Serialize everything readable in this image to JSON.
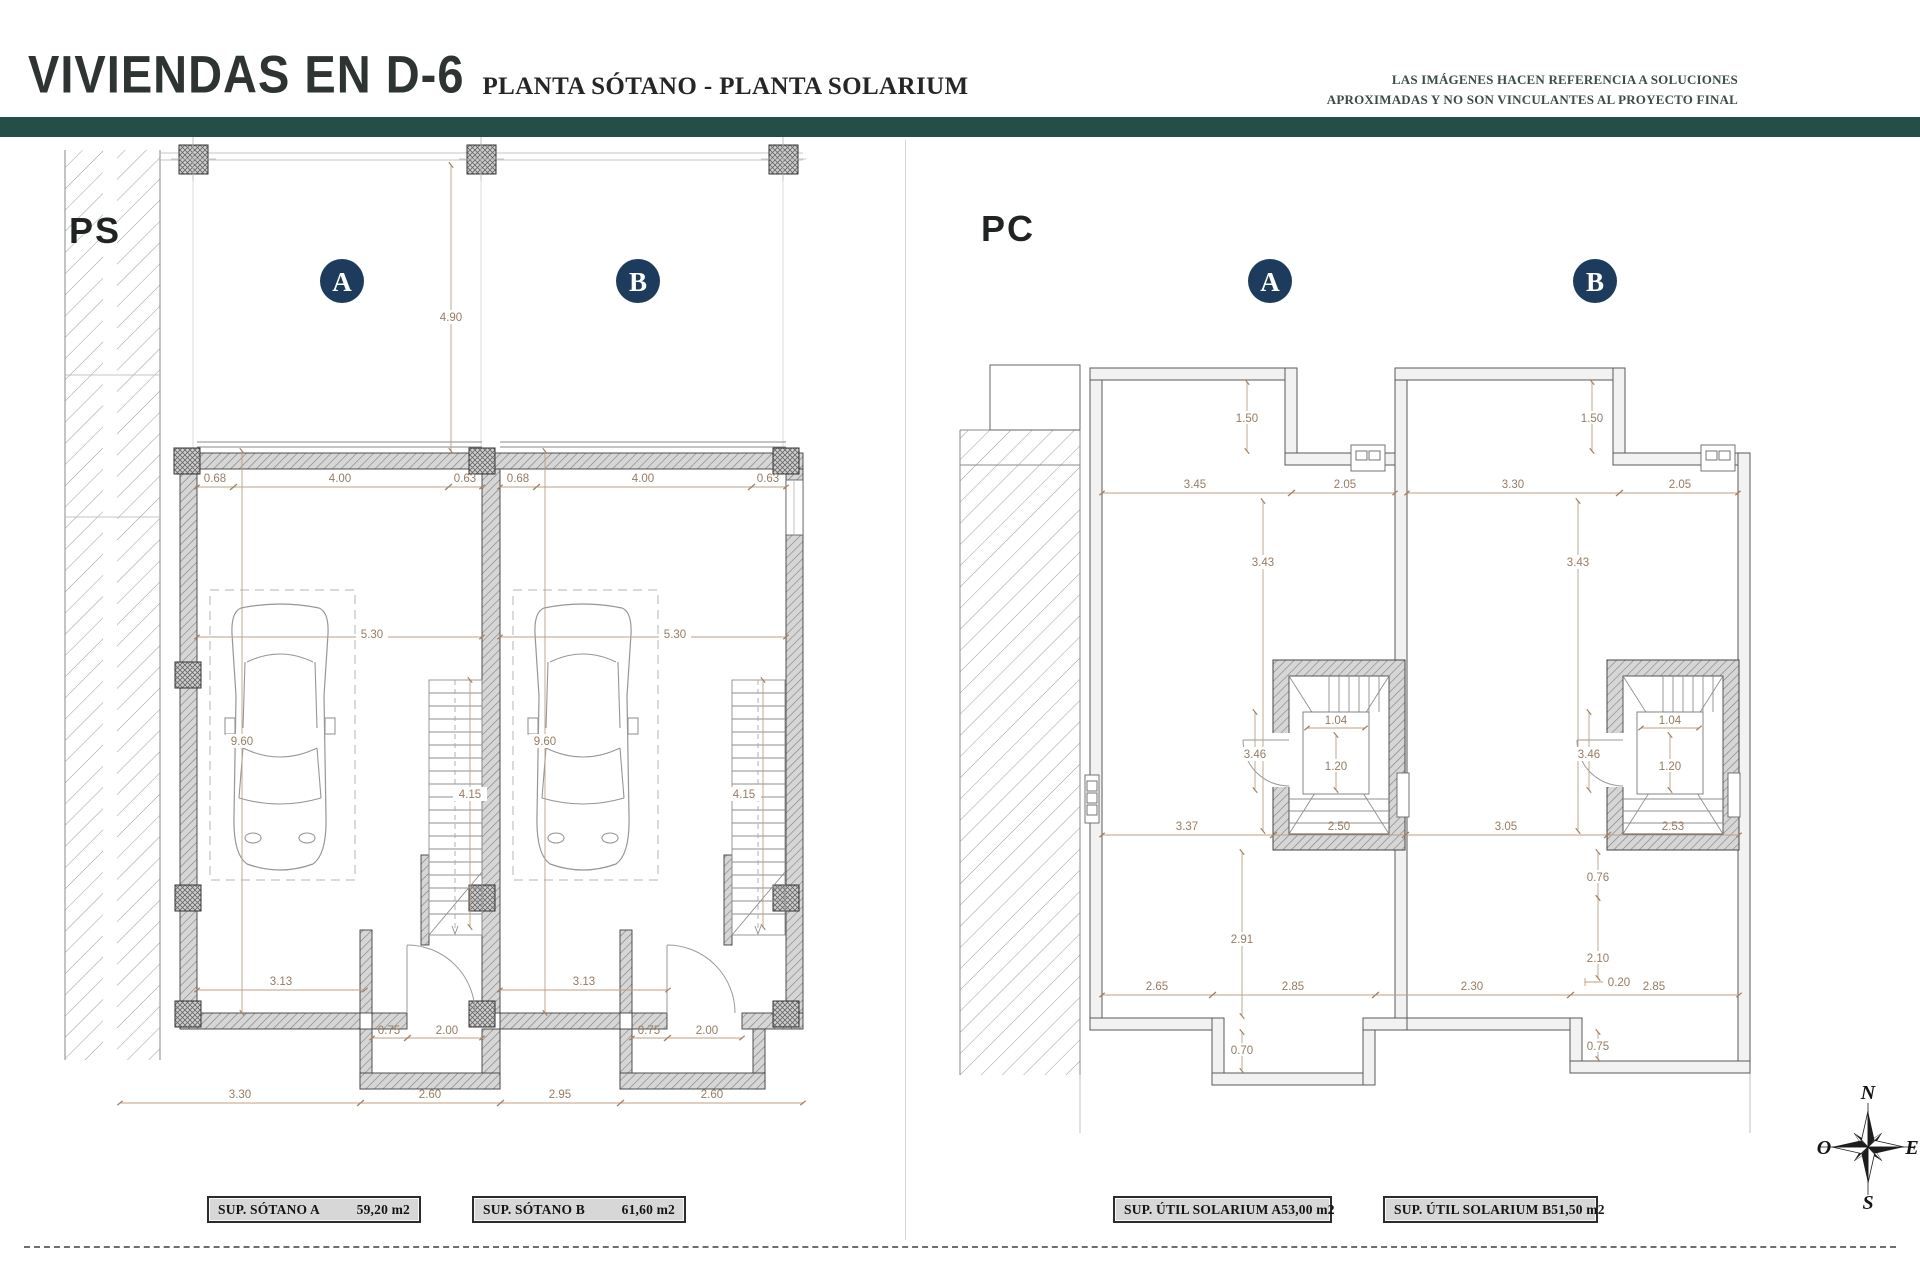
{
  "header": {
    "title": "VIVIENDAS EN D-6",
    "subtitle": "PLANTA SÓTANO - PLANTA SOLARIUM",
    "disclaimer1": "LAS IMÁGENES HACEN REFERENCIA A SOLUCIONES",
    "disclaimer2": "APROXIMADAS Y NO SON VINCULANTES AL PROYECTO FINAL"
  },
  "plans": {
    "ps": {
      "code": "PS",
      "unit_a": "A",
      "unit_b": "B",
      "dims": {
        "top_span": "4.90",
        "a_left": "0.68",
        "a_main": "4.00",
        "a_right": "0.63",
        "b_left": "0.68",
        "b_main": "4.00",
        "b_right": "0.63",
        "a_width": "5.30",
        "b_width": "5.30",
        "a_depth": "9.60",
        "b_depth": "9.60",
        "a_stair": "4.15",
        "b_stair": "4.15",
        "a_room": "3.13",
        "b_room": "3.13",
        "a_pier": "0.75",
        "a_door": "2.00",
        "b_pier": "0.75",
        "b_door": "2.00",
        "bottom_1": "3.30",
        "bottom_2": "2.60",
        "bottom_3": "2.95",
        "bottom_4": "2.60"
      }
    },
    "pc": {
      "code": "PC",
      "unit_a": "A",
      "unit_b": "B",
      "dims": {
        "a_drop": "1.50",
        "b_drop": "1.50",
        "a_top_1": "3.45",
        "a_top_2": "2.05",
        "b_top_1": "3.30",
        "b_top_2": "2.05",
        "a_mid_v": "3.43",
        "b_mid_v": "3.43",
        "mid_1": "3.37",
        "mid_2": "2.50",
        "mid_3": "3.05",
        "mid_4": "2.53",
        "a_stair_w": "1.04",
        "a_stair_h": "1.20",
        "a_stair_side": "3.46",
        "b_stair_w": "1.04",
        "b_stair_h": "1.20",
        "b_stair_side": "3.46",
        "a_low_v": "2.91",
        "a_bay": "0.70",
        "low_1": "2.65",
        "low_2": "2.85",
        "low_3": "2.30",
        "low_4": "2.85",
        "b_low_1": "0.76",
        "b_low_2": "2.10",
        "b_low_3": "0.20",
        "b_low_4": "0.75"
      }
    }
  },
  "area_labels": [
    {
      "name": "SUP. SÓTANO A",
      "value": "59,20 m2"
    },
    {
      "name": "SUP. SÓTANO B",
      "value": "61,60 m2"
    },
    {
      "name": "SUP. ÚTIL SOLARIUM A",
      "value": "53,00 m2"
    },
    {
      "name": "SUP. ÚTIL SOLARIUM B",
      "value": "51,50 m2"
    }
  ],
  "compass": {
    "north": "N",
    "south": "S",
    "east": "E",
    "west": "O"
  }
}
